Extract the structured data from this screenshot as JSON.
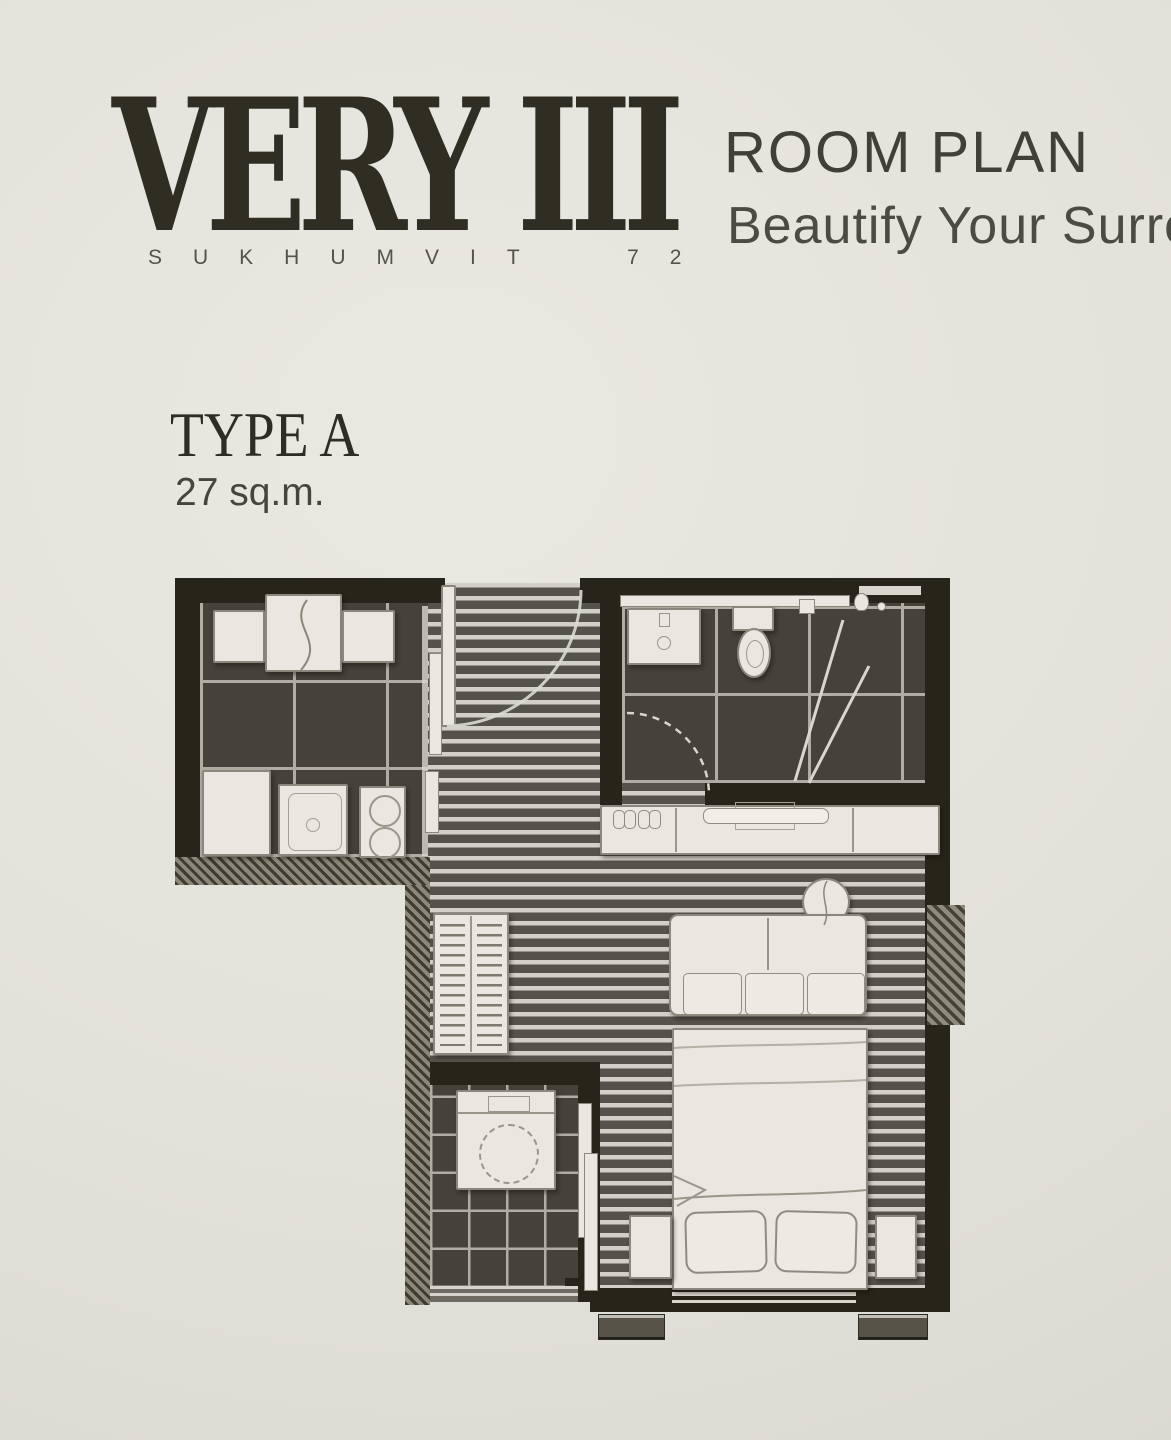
{
  "theme": {
    "paper": "#e3e2da",
    "logo": "#302e23",
    "title": "#413f39",
    "tagline": "#4b4a43",
    "wall": "#272419",
    "tile": "#45423a",
    "grout": "#b0aea3",
    "plank-light": "#d3d1c7",
    "plank-dark": "#55524b",
    "furniture": "#e9e7df",
    "furniture-line": "#8b877c"
  },
  "header": {
    "logo": {
      "wordmark": "VERY III",
      "subtitle": "SUKHUMVIT 72"
    },
    "title": "ROOM PLAN",
    "tagline": "Beautify Your Surrou"
  },
  "unit": {
    "type": "TYPE A",
    "area": "27 sq.m."
  }
}
